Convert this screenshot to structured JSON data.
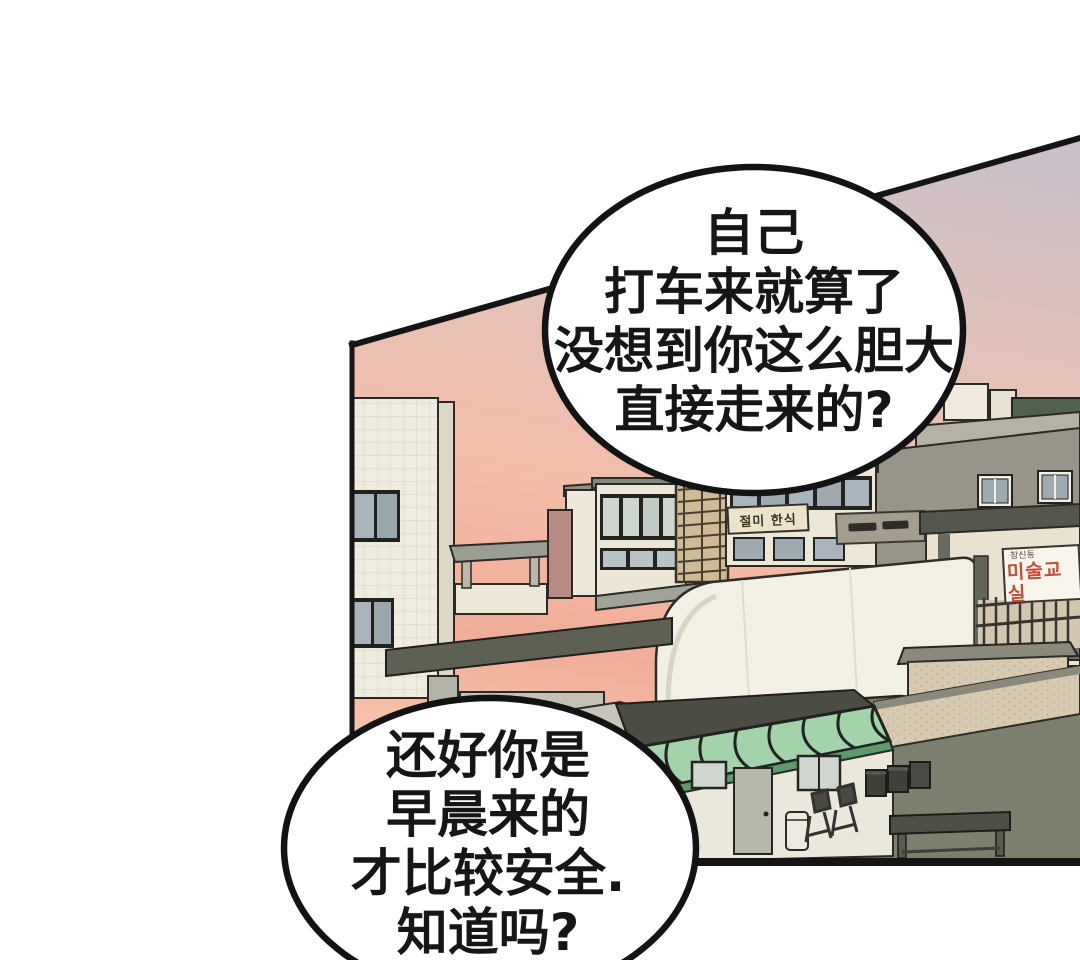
{
  "bubbles": {
    "top": {
      "lines": [
        "自己",
        "打车来就算了",
        "没想到你这么胆大",
        "直接走来的?"
      ]
    },
    "bottom": {
      "lines": [
        "还好你是",
        "早晨来的",
        "才比较安全.",
        "知道吗?"
      ]
    }
  },
  "signs": {
    "restaurant": {
      "text": "절미 한식"
    },
    "art_class": {
      "small_text": "창신동",
      "main_text": "미술교실"
    }
  },
  "colors": {
    "background": "#ffffff",
    "line": "#161616",
    "sky_top": "#cbc0c7",
    "sky_mid": "#f3bda8",
    "sky_glow": "#f1ad97",
    "building_cream": "#efe9dc",
    "roof_olive": "#5f6054",
    "floor_olive": "#7d7f6e",
    "awning_green": "#a2d3ab",
    "brick_tan": "#d8cab1",
    "sign_red": "#c64a38",
    "bubble_fill": "#ffffff"
  }
}
